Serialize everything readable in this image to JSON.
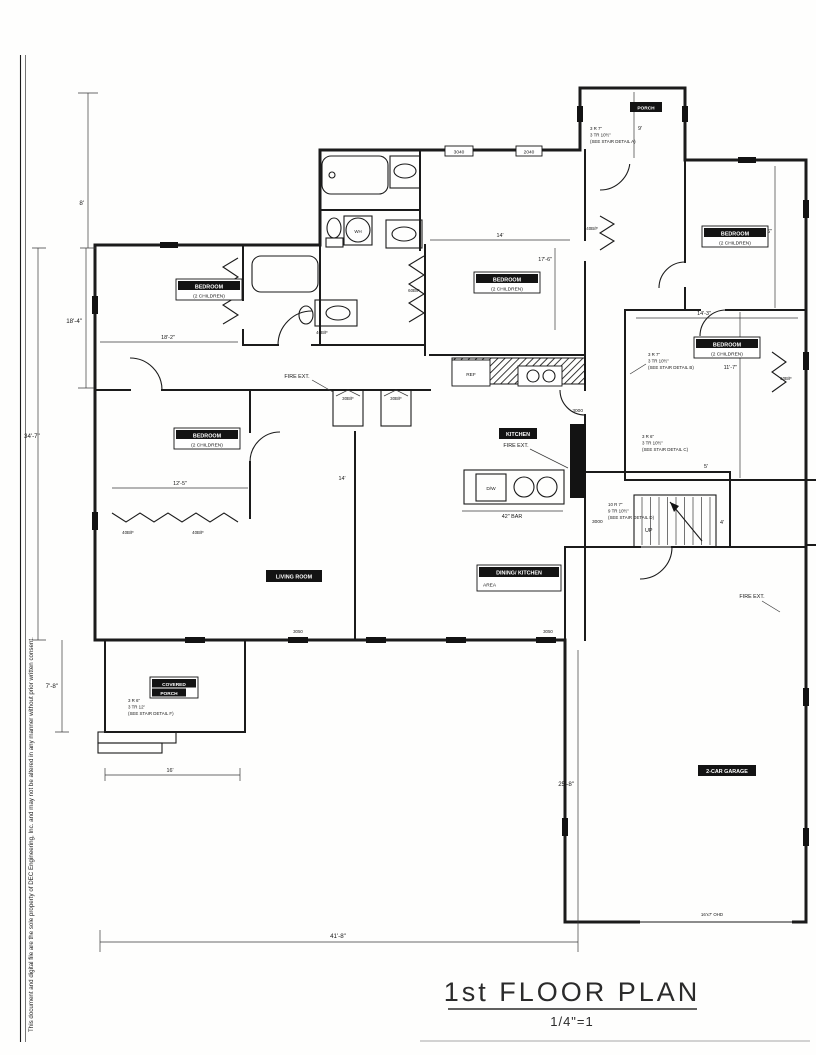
{
  "document": {
    "title": "1st FLOOR PLAN",
    "scale": "1/4\"=1",
    "side_note": "This document and digital file are the sole property of DEC Engineering, Inc. and may not be altered in any manner without prior written consent."
  },
  "rooms": {
    "bedroom_upper_left": {
      "name": "BEDROOM",
      "occupancy": "(2 CHILDREN)"
    },
    "bedroom_center": {
      "name": "BEDROOM",
      "occupancy": "(2 CHILDREN)"
    },
    "bedroom_right": {
      "name": "BEDROOM",
      "occupancy": "(2 CHILDREN)"
    },
    "bedroom_mid_right": {
      "name": "BEDROOM",
      "occupancy": "(2 CHILDREN)"
    },
    "bedroom_lower_left": {
      "name": "BEDROOM",
      "occupancy": "(2 CHILDREN)"
    },
    "kitchen": {
      "name": "KITCHEN"
    },
    "living_room": {
      "name": "LIVING ROOM"
    },
    "dining": {
      "name": "DINING/ KITCHEN",
      "name2": "AREA"
    },
    "covered_porch": {
      "name": "COVERED",
      "name2": "PORCH"
    },
    "garage": {
      "name": "2-CAR GARAGE"
    },
    "porch": {
      "name": "PORCH"
    }
  },
  "dimensions": {
    "left_top": "8'",
    "left_upper": "18'-4\"",
    "left_main": "34'-7\"",
    "left_porch": "7'-8\"",
    "bottom": "41'-8\"",
    "garage_side": "25'-8\"",
    "bedroom_ul_width": "18'-2\"",
    "bedroom_ll_width": "12'-5\"",
    "center_width": "14'",
    "center_depth": "17'-6\"",
    "bedroom_right_width": "11'-6\"",
    "bedroom_mid_right_width": "11'-7\"",
    "mid_right_width": "14'-3\"",
    "porch_depth": "9'",
    "living_width": "14'",
    "covered_porch_width": "16'",
    "stair_width": "4'",
    "hall_width": "5'",
    "bar": "42\" BAR",
    "garage_door": "16'x7' OHD"
  },
  "stair_notes": {
    "a": [
      "3 R 7\"",
      "3 TR 10½\"",
      "(SEE STAIR DETAIL A)"
    ],
    "b": [
      "3 R 7\"",
      "3 TR 10½\"",
      "(SEE STAIR DETAIL B)"
    ],
    "c": [
      "3 R 6\"",
      "3 TR 10½\"",
      "(SEE STAIR DETAIL C)"
    ],
    "d": [
      "10 R 7\"",
      "9 TR 10½\"",
      "(SEE STAIR DETAIL D)"
    ],
    "f": [
      "3 R 6\"",
      "3 TR 12\"",
      "(SEE STAIR DETAIL F)"
    ]
  },
  "labels": {
    "fire_ext": "FIRE EXT.",
    "ref": "REF",
    "dw": "D/W",
    "wh": "WH",
    "up": "UP"
  },
  "doors": {
    "bf60": "60B/F",
    "bf40": "40B/F",
    "bf30": "30B/F"
  },
  "windows": {
    "w3040": "3040",
    "w2040": "2040",
    "w3000": "3000",
    "w3050": "3050"
  }
}
